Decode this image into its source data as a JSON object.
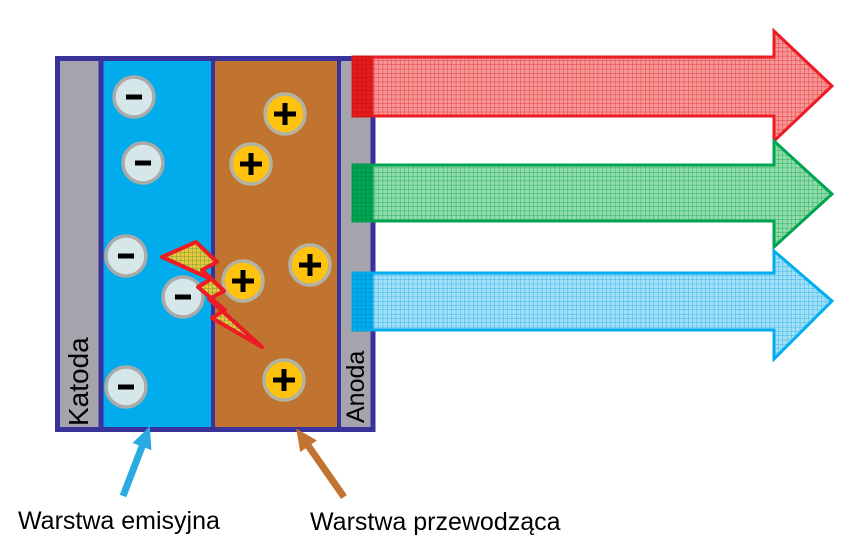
{
  "structure": {
    "border_color": "#3a329b",
    "background": "#ffffff"
  },
  "layers": {
    "cathode": {
      "label": "Katoda",
      "color": "#a5a4ac"
    },
    "emissive": {
      "color": "#00aceb"
    },
    "conductive": {
      "color": "#c0742f"
    },
    "anode": {
      "label": "Anoda",
      "color": "#a5a4ac"
    }
  },
  "charges": {
    "negative": {
      "symbol": "-",
      "fill": "#d5e7e9",
      "stroke": "#a9aaa9",
      "positions": [
        [
          134,
          97
        ],
        [
          143,
          163
        ],
        [
          126,
          256
        ],
        [
          183,
          297
        ],
        [
          126,
          387
        ]
      ]
    },
    "positive": {
      "symbol": "+",
      "fill": "#ffc20e",
      "stroke": "#b3b3a4",
      "positions": [
        [
          285,
          114
        ],
        [
          251,
          164
        ],
        [
          310,
          265
        ],
        [
          243,
          281
        ],
        [
          284,
          380
        ]
      ]
    }
  },
  "recombination_bolt": {
    "stroke": "#ec1c24",
    "fill_bg": "#ecc53e",
    "fill_grid": "#69a73c",
    "points": "196,242 217,262 202,270 224,291 209,299 262,347 212,318 225,310 198,287 211,279 162,257"
  },
  "light_arrow_x": {
    "start": 353,
    "head_base": 774,
    "tip": 832,
    "stripe_width": 22
  },
  "light_arrows": [
    {
      "id": "red",
      "stroke": "#ed1c24",
      "fill": "#f69697",
      "grid": "#e43c3c",
      "solid": "#e81b1b",
      "body_top": 57,
      "body_bottom": 116,
      "head_top": 31,
      "head_bottom": 141,
      "tip_y": 86
    },
    {
      "id": "green",
      "stroke": "#00a551",
      "fill": "#90dcab",
      "grid": "#27ad5c",
      "solid": "#00a551",
      "body_top": 165,
      "body_bottom": 221,
      "head_top": 141,
      "head_bottom": 247,
      "tip_y": 194
    },
    {
      "id": "blue",
      "stroke": "#00aeef",
      "fill": "#a3e0f7",
      "grid": "#33b4e8",
      "solid": "#00aeef",
      "body_top": 273,
      "body_bottom": 330,
      "head_top": 251,
      "head_bottom": 359,
      "tip_y": 301
    }
  ],
  "annotations": [
    {
      "label": "Warstwa emisyjna",
      "color": "#29abe2"
    },
    {
      "label": "Warstwa przewodząca",
      "color": "#c0742f"
    }
  ]
}
